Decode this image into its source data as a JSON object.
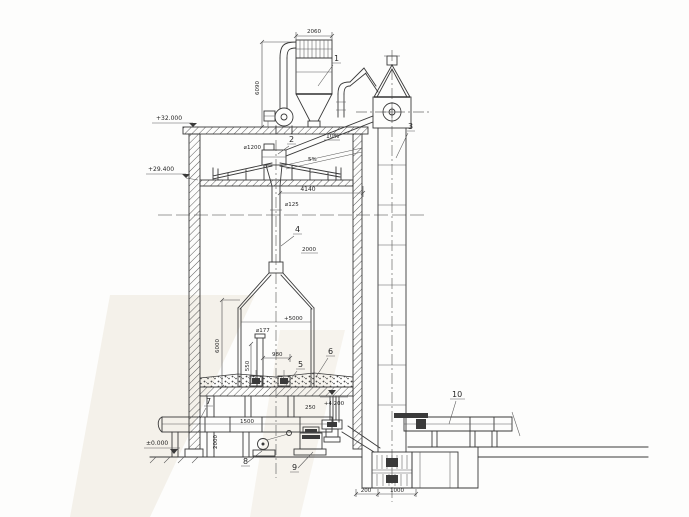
{
  "drawing": {
    "parts": {
      "p1": "1",
      "p2": "2",
      "p3": "3",
      "p4": "4",
      "p5": "5",
      "p6": "6",
      "p7": "7",
      "p8": "8",
      "p9": "9",
      "p10": "10"
    },
    "elevations": {
      "roof": "+32.000",
      "upper_floor": "+29.400",
      "fill_top": "+4.200",
      "ground": "±0.000"
    },
    "dims": {
      "filter_width": "2060",
      "collector_height": "6090",
      "distributor_dia": "⌀1200",
      "slope_chute": "10%",
      "slope_cone": "5%",
      "span": "4140",
      "center_pipe_dia": "⌀125",
      "mid": "2000",
      "cone_level": "+5000",
      "inner_pipe_dia": "⌀177",
      "cone_height": "6000",
      "d980": "980",
      "d550": "550",
      "d250": "250",
      "duct_len": "1500",
      "basement_h": "2000",
      "boot_left": "200",
      "boot_right": "1000"
    },
    "colors": {
      "ink": "#3a3a3a",
      "paper": "#fdfdfc"
    }
  }
}
